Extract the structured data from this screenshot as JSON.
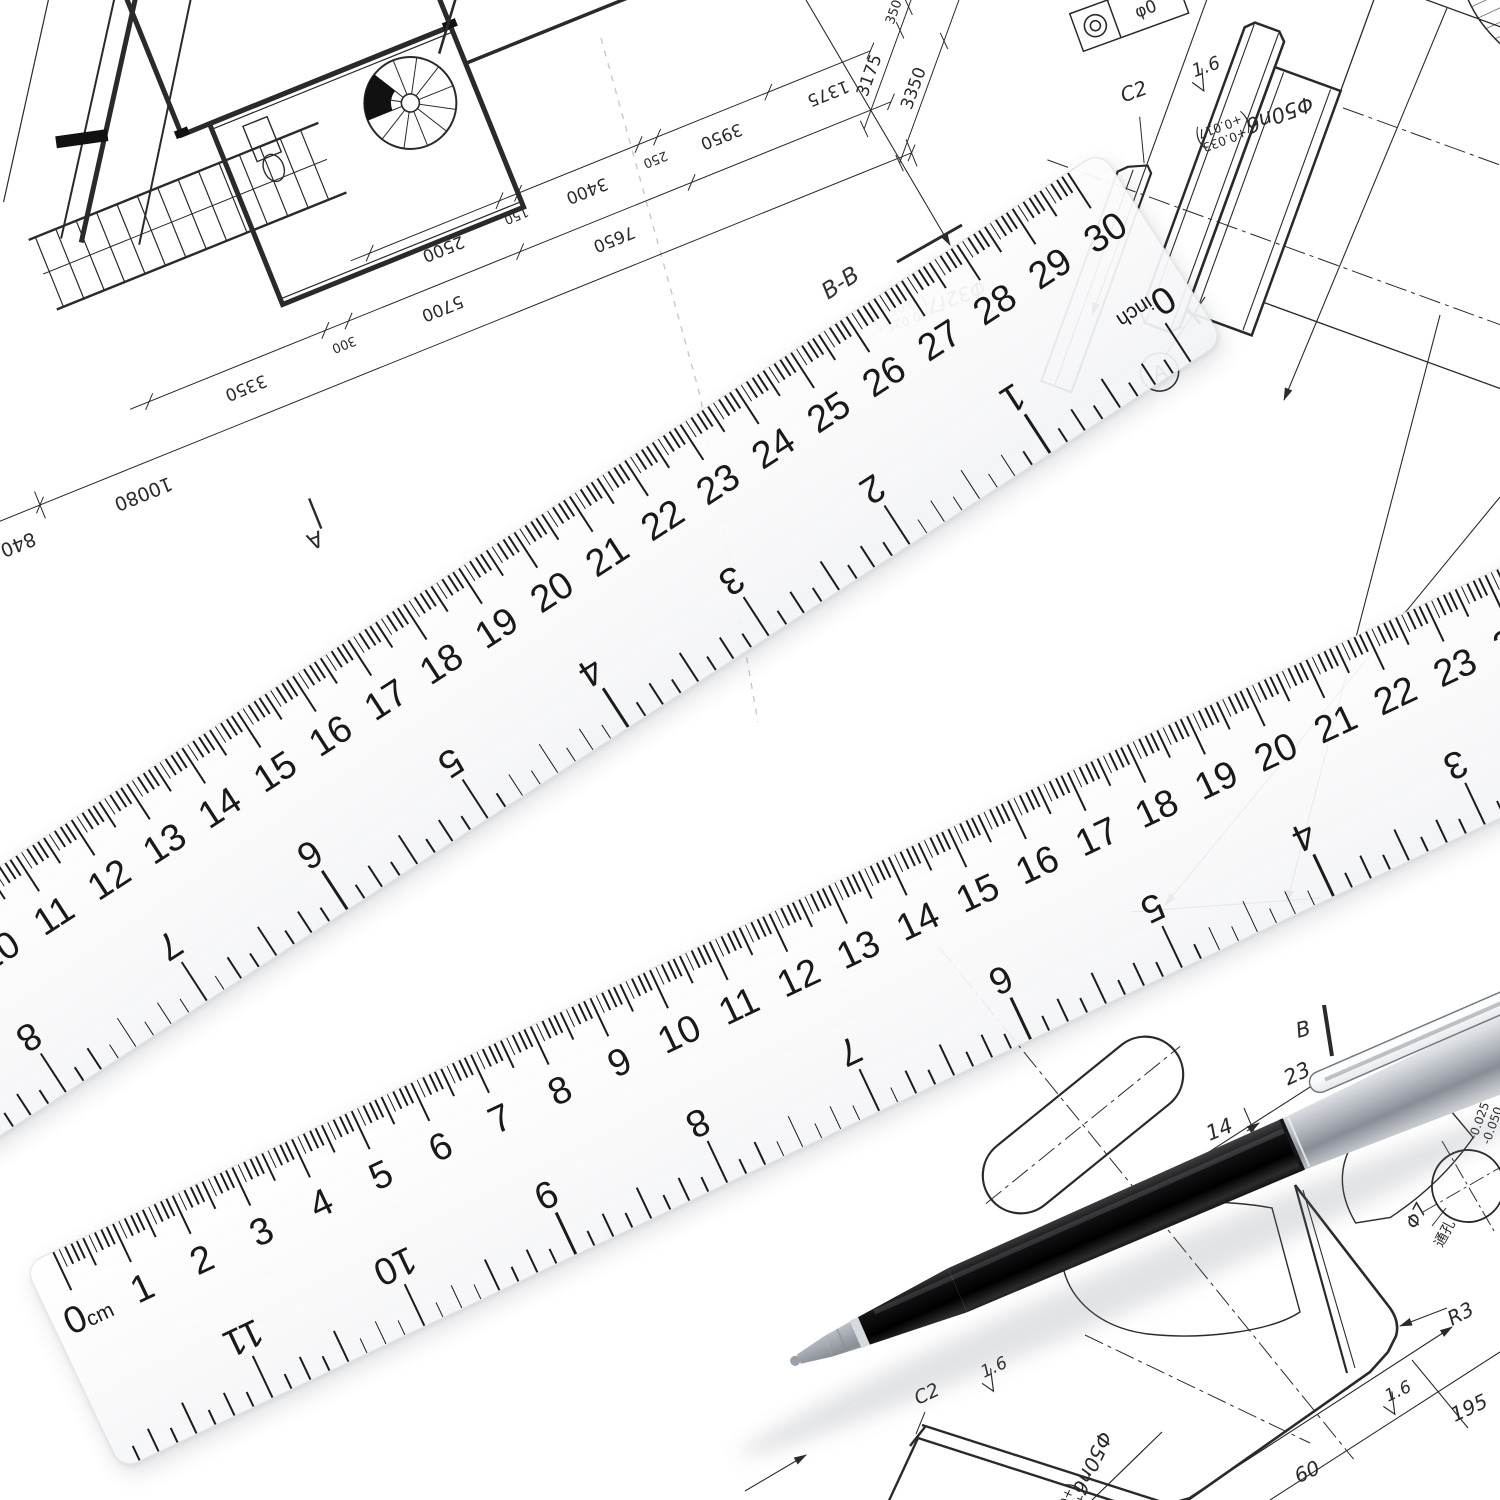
{
  "scene": {
    "paper_color": "#ffffff",
    "ink_color": "#2a2a2a",
    "tick_color": "#1c1c1c",
    "pen_black": "#0d0d0d",
    "pen_silver": "#c9ccd2"
  },
  "rulers": {
    "px_per_cm": 66,
    "px_per_inch": 167.64,
    "margin_px": 30,
    "height_px": 225,
    "cm_max": 30,
    "inch_max": 12,
    "unit_cm": "cm",
    "unit_inch": "inch",
    "zero": "0",
    "cm_numbers": [
      "1",
      "2",
      "3",
      "4",
      "5",
      "6",
      "7",
      "8",
      "9",
      "10",
      "11",
      "12",
      "13",
      "14",
      "15",
      "16",
      "17",
      "18",
      "19",
      "20",
      "21",
      "22",
      "23",
      "24",
      "25",
      "26",
      "27",
      "28",
      "29",
      "30"
    ],
    "inch_numbers": [
      "1",
      "2",
      "3",
      "4",
      "5",
      "6",
      "7",
      "8",
      "9",
      "10",
      "11",
      "12"
    ]
  },
  "floor_plan": {
    "right_chain_inner": [
      "3175",
      "350",
      "1125"
    ],
    "right_chain_outer": [
      "3350",
      "4200"
    ],
    "bottom_row1": [
      "3350",
      "300",
      "5700",
      "7650"
    ],
    "bottom_row2": [
      "2500",
      "150",
      "3400",
      "250",
      "3950",
      "1375"
    ],
    "overall": [
      "10080",
      "840"
    ],
    "marker": "A"
  },
  "shaft_drawing": {
    "section_label": "B-B",
    "chamfer": "C2",
    "roughness": "1.6",
    "gdt_value": "φ0",
    "dia_label": "Φ50n6",
    "dia_tol_upper": "+0.033",
    "dia_tol_lower": "+0.017",
    "shaft_label": "Φ32f7",
    "shaft_tol_upper": "-0.025",
    "shaft_tol_lower": "-0.050",
    "datum": "A"
  },
  "plate_drawing": {
    "dim_23": "23",
    "dim_14": "14",
    "dim_60": "60",
    "dim_195": "195",
    "radius": "R3",
    "roughness1": "1.6",
    "roughness2": "1.6",
    "chamfer": "C2",
    "section_label": "B",
    "hole_dia": "Φ7",
    "hole_dia_top": "Φ7",
    "hole_note": "通孔",
    "dia_label": "Φ50n6",
    "dia_tol_upper": "+0.033",
    "dia_tol_lower": "+0.017",
    "edge_tol_upper": "-0.025",
    "edge_tol_lower": "-0.050"
  }
}
